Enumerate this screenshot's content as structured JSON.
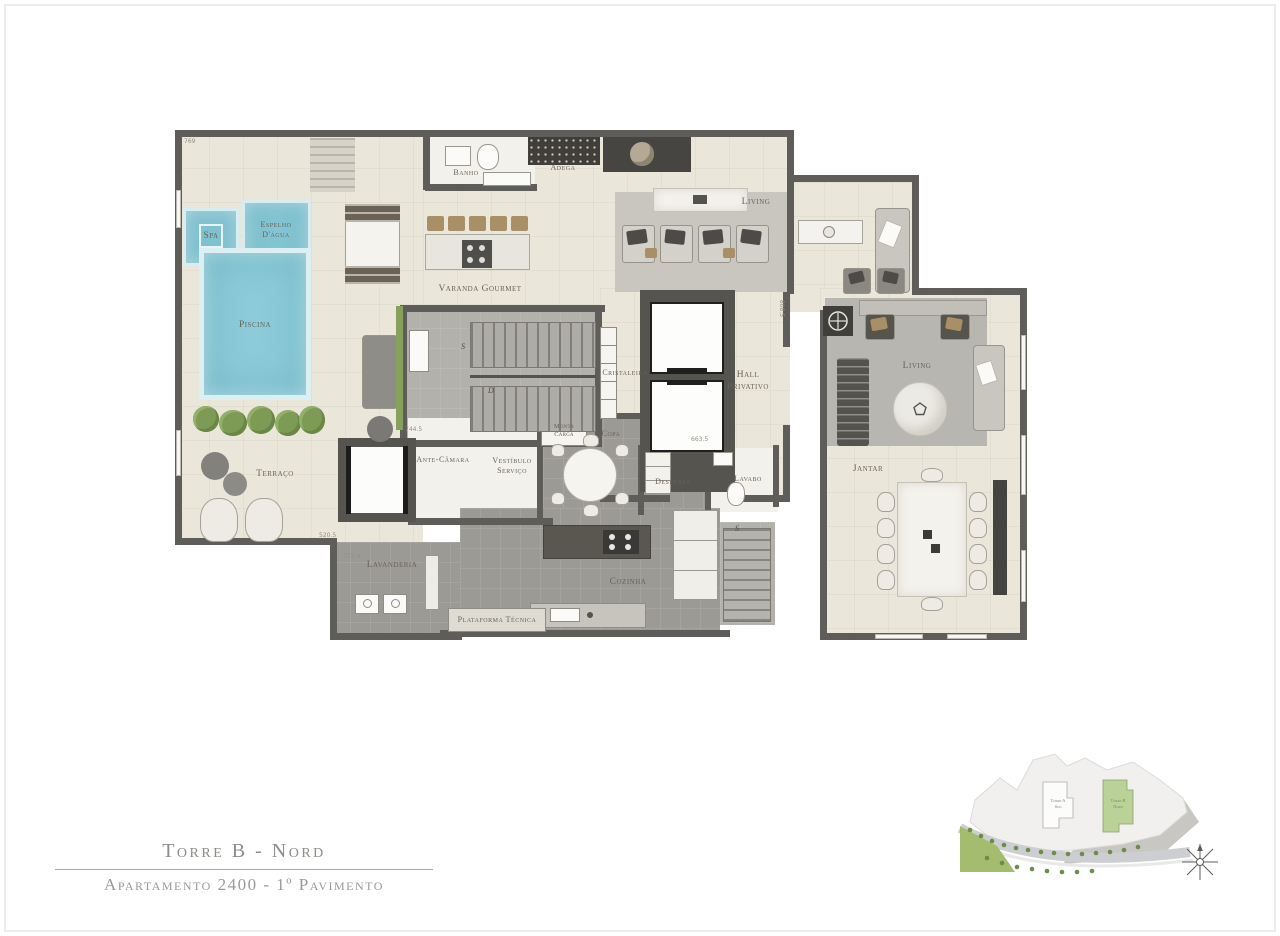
{
  "titles": {
    "tower": "Torre B - Nord",
    "apartment": "Apartamento 2400 - 1º Pavimento"
  },
  "labels": {
    "spa": "Spa",
    "espelho": "Espelho\nD'água",
    "piscina": "Piscina",
    "terraco": "Terraço",
    "banho": "Banho",
    "adega": "Adega",
    "varanda": "Varanda Gourmet",
    "living_main": "Living",
    "living_right": "Living",
    "cristaleira": "Cristaleira",
    "hall": "Hall\nPrivativo",
    "monta_carga": "Monta\nCarga",
    "ante_camara": "Ante-Câmara",
    "vestibulo": "Vestíbulo\nServiço",
    "copa": "Copa",
    "despensa": "Despensa",
    "lavabo": "Lavabo",
    "jantar": "Jantar",
    "cozinha": "Cozinha",
    "lavanderia": "Lavanderia",
    "plataforma": "Plataforma Técnica"
  },
  "stairs": {
    "up1": "S",
    "down1": "D",
    "up2": "S"
  },
  "dims": {
    "d1": "769",
    "d2": "744.5",
    "d3": "520.5",
    "d4": "772.4",
    "d5": "808.5",
    "d6": "663.5"
  },
  "site": {
    "tower_a_l1": "Torre A",
    "tower_a_l2": "Sud",
    "tower_b_l1": "Torre B",
    "tower_b_l2": "Nord"
  },
  "colors": {
    "pool_blue": "#8ccbd8",
    "wall_gray": "#5e5d59",
    "floor_cream": "#ebe6da",
    "floor_gray": "#9c9a94",
    "tower_highlight_green": "#bad297"
  }
}
